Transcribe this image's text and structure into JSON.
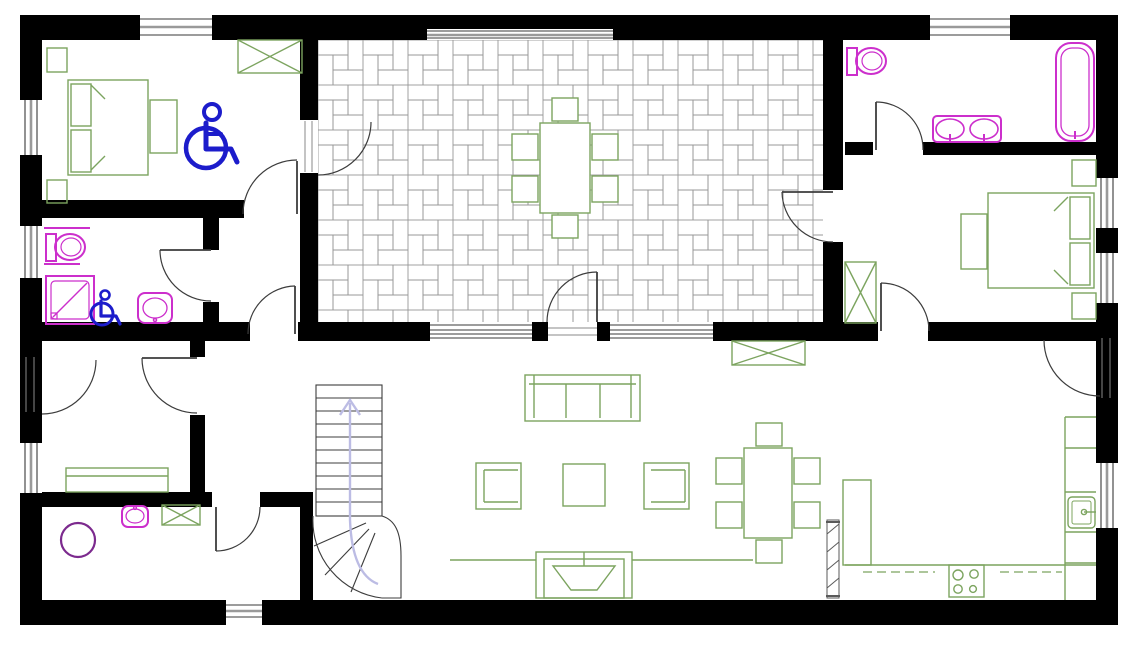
{
  "meta": {
    "type": "floor-plan",
    "view": "top-down ground floor plan",
    "canvas": {
      "width": 1138,
      "height": 646
    }
  },
  "colors": {
    "wall": "#000000",
    "door": "#3c3c3c",
    "window": "#3a3a3a",
    "tile": "#969696",
    "furniture": "#7ca45f",
    "sanitary": "#cc2fcc",
    "washer": "#7c2a8e",
    "accessible": "#1c1ccb",
    "stairs-arrow": "#bcbce4",
    "radiator": "#5a5a5a"
  },
  "rooms": [
    {
      "id": "accessible-bedroom",
      "position": "top-left",
      "furniture": [
        "double-bed",
        "pillow",
        "pillow",
        "nightstand",
        "nightstand",
        "foot-bench",
        "wardrobe-crossed",
        "wheelchair-symbol"
      ]
    },
    {
      "id": "accessible-bathroom",
      "position": "mid-left",
      "furniture": [
        "toilet-with-grab-bars",
        "roll-in-shower",
        "washbasin",
        "wheelchair-symbol-small"
      ]
    },
    {
      "id": "inner-corridor",
      "position": "mid-left",
      "furniture": []
    },
    {
      "id": "study",
      "position": "left-middle",
      "furniture": [
        "sideboard-bench"
      ]
    },
    {
      "id": "utility-laundry",
      "position": "bottom-left",
      "furniture": [
        "washing-machine-drum",
        "washbasin-small",
        "cabinet-crossed"
      ]
    },
    {
      "id": "tiled-hall",
      "position": "top-center",
      "floor": "pinwheel-tile-pattern",
      "furniture": [
        "dining-table",
        "chair",
        "chair",
        "chair",
        "chair",
        "chair",
        "chair"
      ]
    },
    {
      "id": "bathroom-2",
      "position": "top-right",
      "furniture": [
        "toilet",
        "double-washbasin-vanity",
        "bathtub"
      ]
    },
    {
      "id": "bedroom-2",
      "position": "right",
      "furniture": [
        "double-bed",
        "pillow",
        "pillow",
        "nightstand",
        "nightstand",
        "foot-bench",
        "wardrobe-crossed"
      ]
    },
    {
      "id": "living-dining-kitchen",
      "position": "bottom",
      "furniture": [
        "sofa-3-seat",
        "armchair",
        "armchair",
        "coffee-table",
        "tv-fireplace-unit",
        "media-bench",
        "dining-table",
        "chair",
        "chair",
        "chair",
        "chair",
        "chair",
        "chair",
        "kitchen-counter-u",
        "hob-4-burners",
        "kitchen-sink",
        "dishwasher-dashed",
        "tall-cabinet",
        "radiator",
        "wardrobe-crossed"
      ]
    },
    {
      "id": "staircase",
      "position": "bottom-center-left",
      "furniture": [
        "straight-flight-10-steps",
        "winder-5-steps",
        "up-direction-arrow"
      ]
    }
  ],
  "openings": {
    "windows": 11,
    "hinged_doors": 12,
    "glazed_wall_panels": 2,
    "accessibility_symbols": 2
  }
}
